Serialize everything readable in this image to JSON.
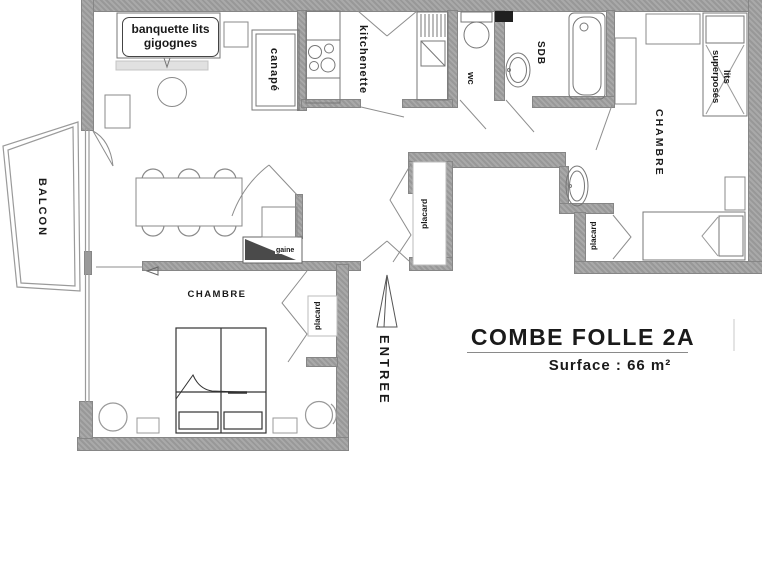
{
  "plan": {
    "title": "COMBE FOLLE 2A",
    "surface": "Surface : 66 m²"
  },
  "labels": {
    "balcon": "BALCON",
    "banquette": "banquette lits gigognes",
    "canape": "canapé",
    "kitchenette": "kitchenette",
    "wc": "wc",
    "sdb": "SDB",
    "chambre_right": "CHAMBRE",
    "lits_superposes": {
      "line1": "lits",
      "line2": "superposés"
    },
    "placard_hall": "placard",
    "placard_chambre_right": "placard",
    "chambre_left": "CHAMBRE",
    "placard_chambre_left": "placard",
    "gaine": "gaine",
    "entree": "ENTREE"
  },
  "colors": {
    "wall": "#9a9a9a",
    "furniture_line": "#666666",
    "text": "#1a1a1a",
    "duct": "#1f1f1f",
    "gaine_fill": "#4a4a4a"
  }
}
